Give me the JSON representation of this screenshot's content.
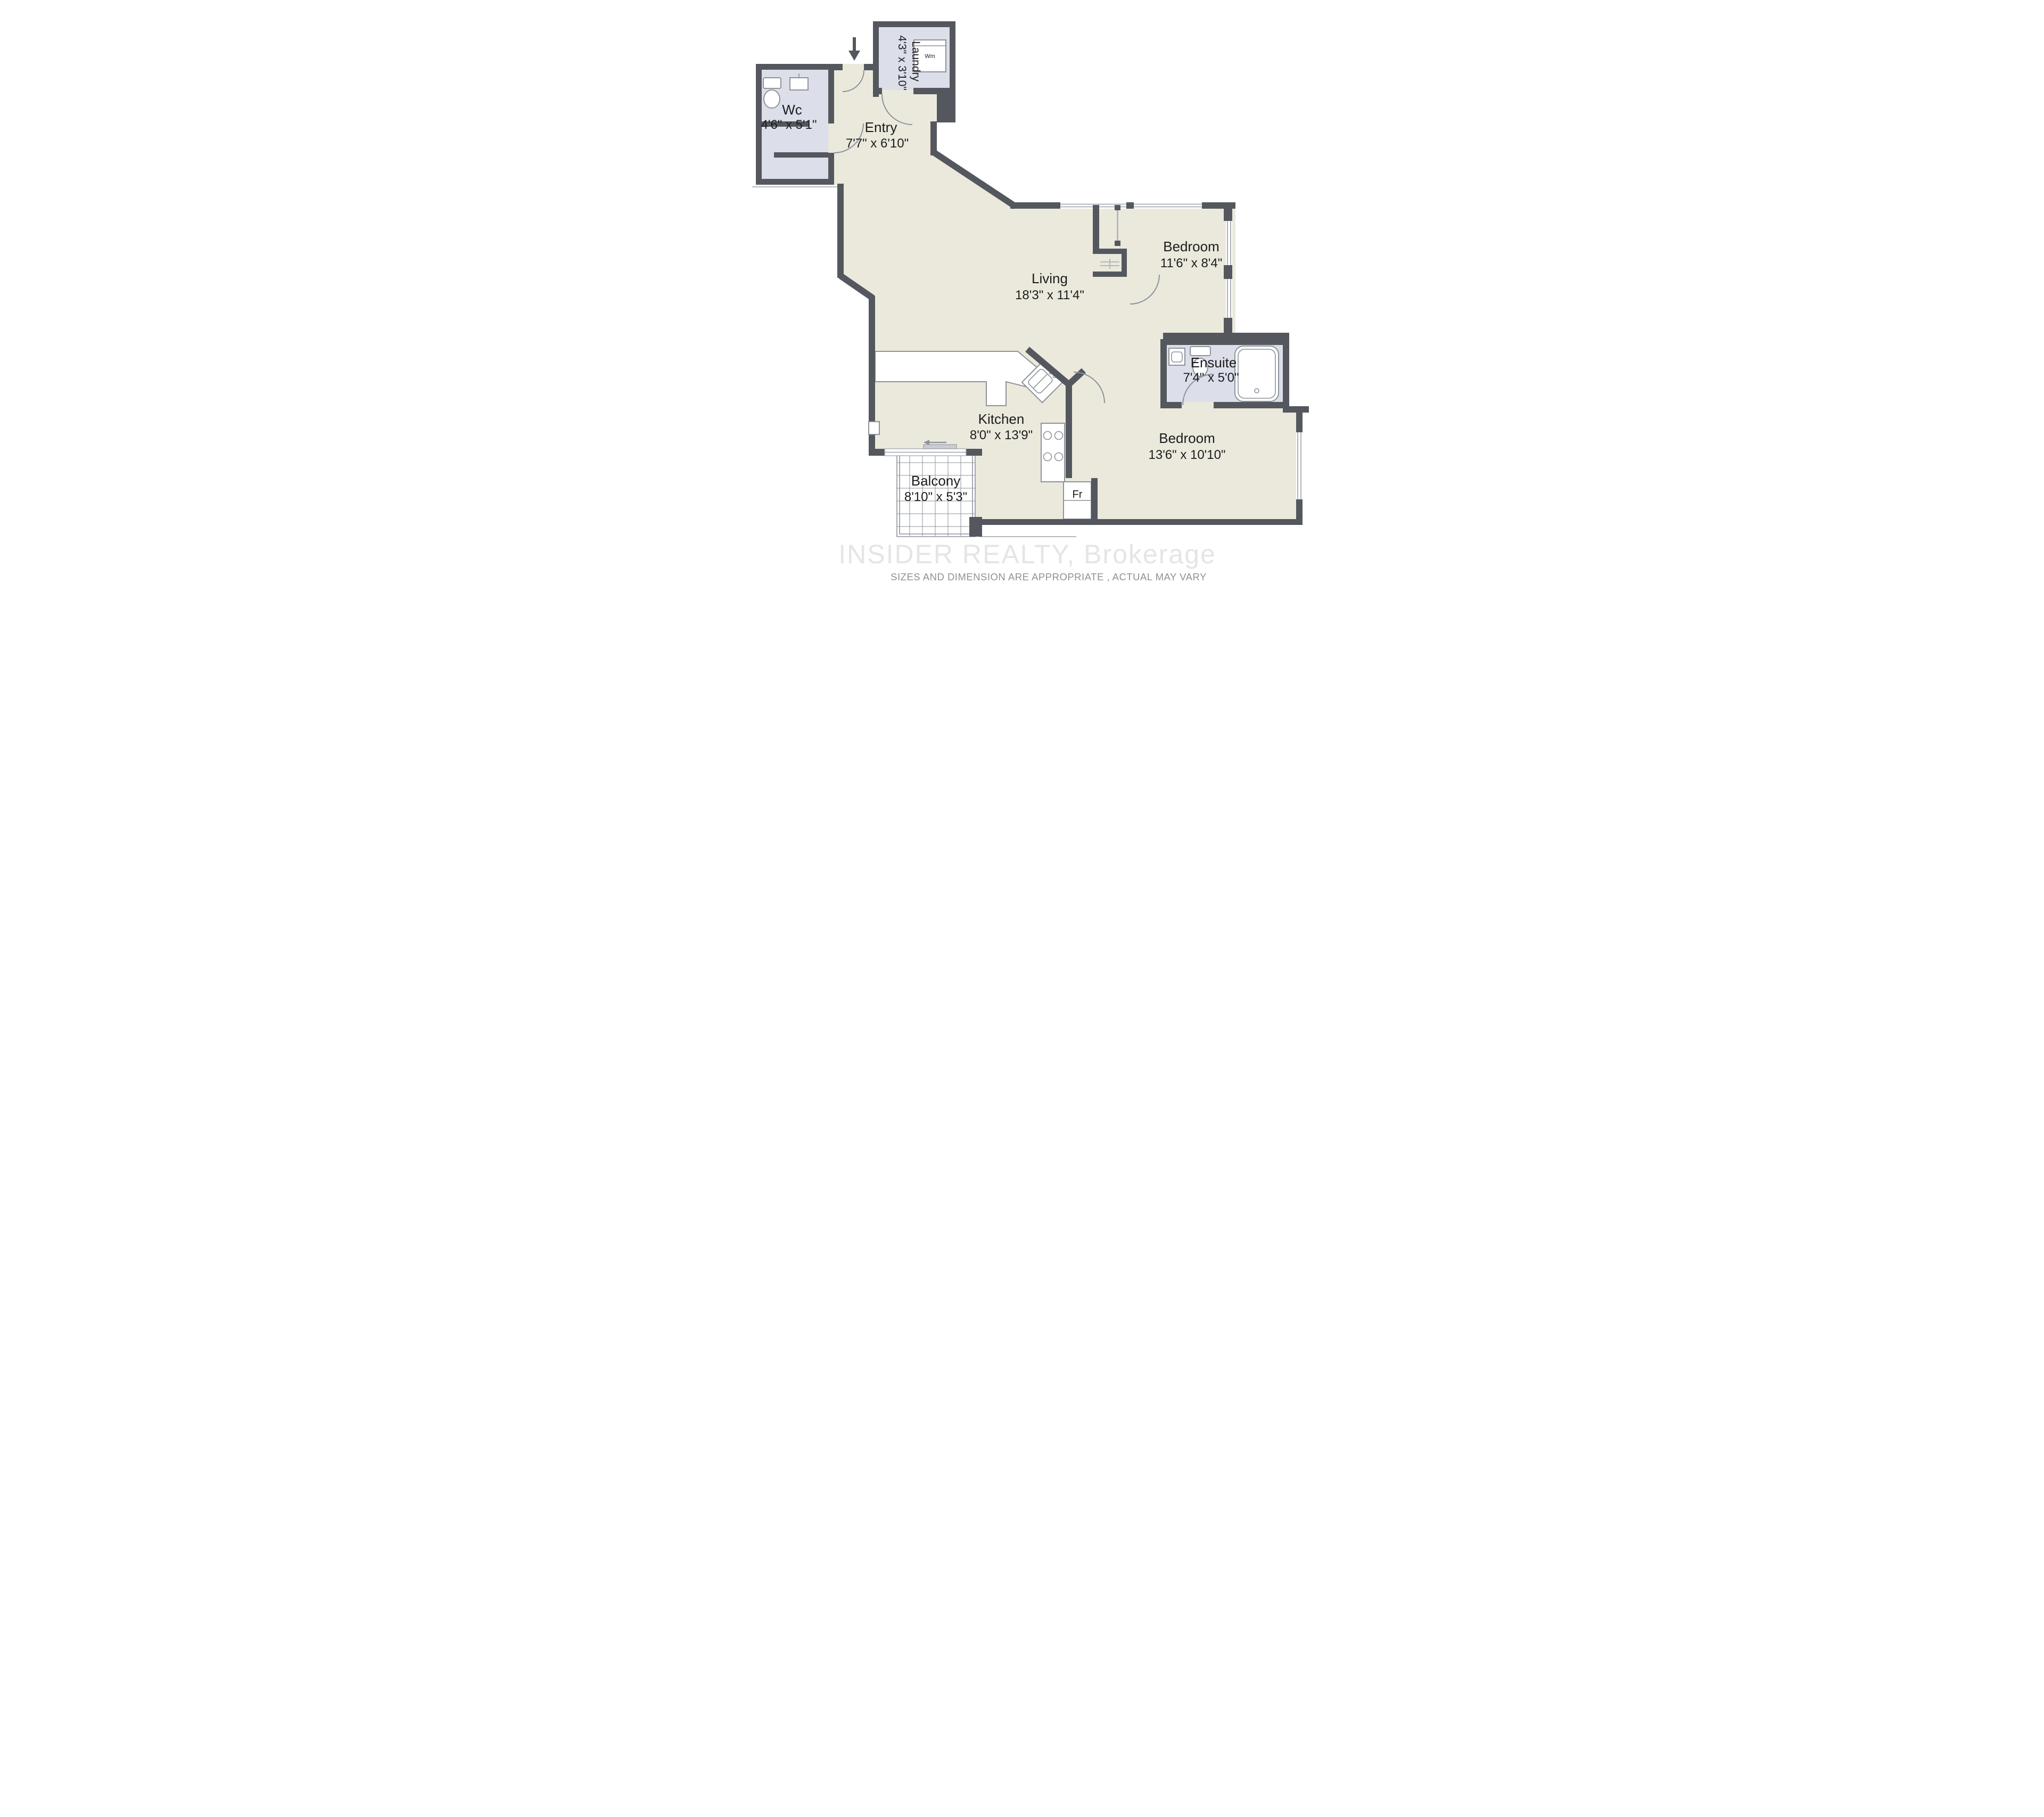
{
  "plan": {
    "rooms": {
      "laundry": {
        "name": "Laundry",
        "dims": "4'3\" x 3'10\""
      },
      "wc": {
        "name": "Wc",
        "dims": "4'6\" x 5'1\""
      },
      "entry": {
        "name": "Entry",
        "dims": "7'7\" x 6'10\""
      },
      "living": {
        "name": "Living",
        "dims": "18'3\" x 11'4\""
      },
      "bedroom1": {
        "name": "Bedroom",
        "dims": "11'6\" x 8'4\""
      },
      "ensuite": {
        "name": "Ensuite",
        "dims": "7'4\" x 5'0\""
      },
      "kitchen": {
        "name": "Kitchen",
        "dims": "8'0\" x 13'9\""
      },
      "bedroom2": {
        "name": "Bedroom",
        "dims": "13'6\" x 10'10\""
      },
      "balcony": {
        "name": "Balcony",
        "dims": "8'10\" x 5'3\""
      }
    },
    "appliances": {
      "washer": "Wm",
      "fridge": "Fr"
    },
    "watermark": "INSIDER REALTY, Brokerage",
    "disclaimer": "SIZES AND DIMENSION ARE APPROPRIATE , ACTUAL MAY VARY",
    "colors": {
      "wall": "#54585e",
      "floor": "#ebe9dc",
      "wet_floor": "#dcdfe9",
      "fixture_outline": "#8d939b",
      "watermark_text": "#e3e3e3",
      "disclaimer_text": "#8f9193"
    }
  }
}
